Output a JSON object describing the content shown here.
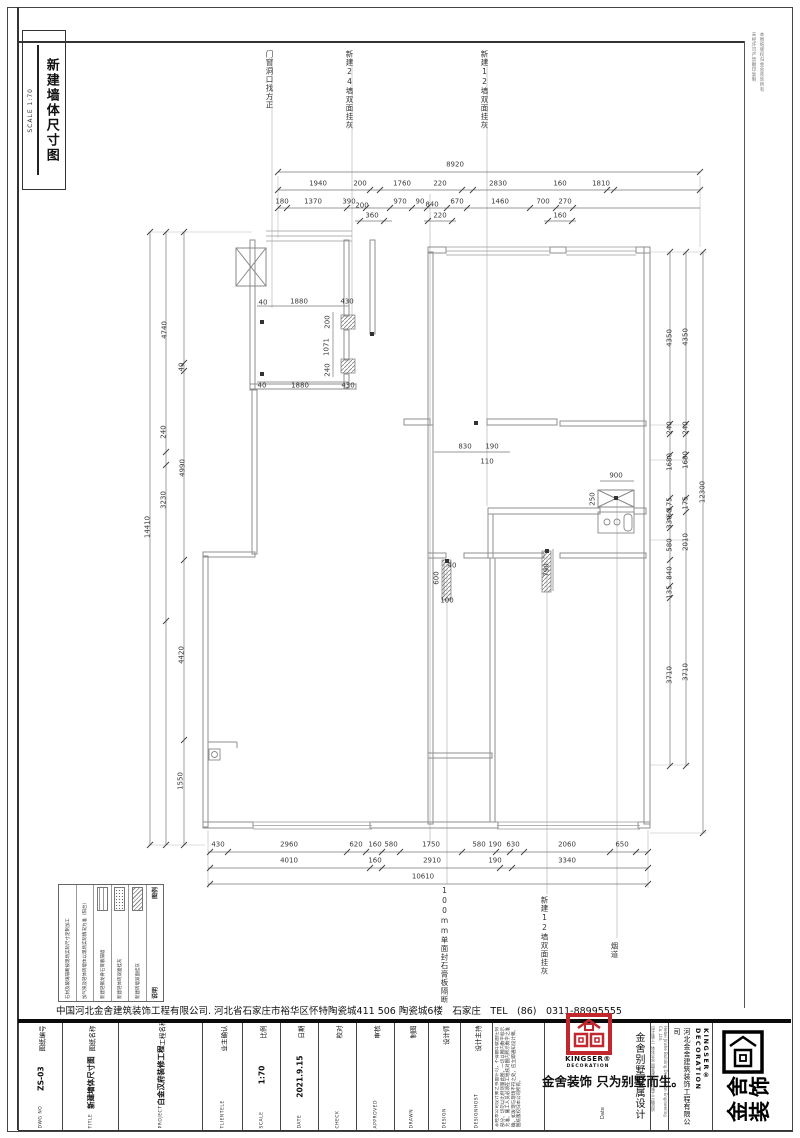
{
  "sheet": {
    "title": "新建墙体尺寸图",
    "scale_label": "SCALE 1:70",
    "margin_note_1": "本图纸版权归金舍装饰所有",
    "margin_note_2": "未经许可严禁翻印复制"
  },
  "company_line": "中国河北金舍建筑装饰工程有限公司. 河北省石家庄市裕华区怀特陶瓷城411 506 陶瓷城6楼　石家庄　TEL　(86)　0311-88995555",
  "annotations": [
    [
      269,
      50,
      "门窗洞口找方正"
    ],
    [
      349,
      50,
      "新建24墙双面挂灰"
    ],
    [
      484,
      50,
      "新建12墙双面挂灰"
    ],
    [
      444,
      886,
      "100mm单面封石膏板隔断"
    ],
    [
      544,
      896,
      "新建12墙双面挂灰"
    ],
    [
      614,
      942,
      "烟道"
    ]
  ],
  "dim_labels": [
    [
      455,
      165,
      "8920",
      0
    ],
    [
      318,
      184,
      "1940",
      0
    ],
    [
      360,
      184,
      "200",
      0
    ],
    [
      402,
      184,
      "1760",
      0
    ],
    [
      440,
      184,
      "220",
      0
    ],
    [
      498,
      184,
      "2830",
      0
    ],
    [
      560,
      184,
      "160",
      0
    ],
    [
      601,
      184,
      "1810",
      0
    ],
    [
      282,
      202,
      "180",
      0
    ],
    [
      313,
      202,
      "1370",
      0
    ],
    [
      349,
      202,
      "390",
      0
    ],
    [
      362,
      206,
      "200",
      0
    ],
    [
      400,
      202,
      "970",
      0
    ],
    [
      420,
      202,
      "90",
      0
    ],
    [
      432,
      205,
      "840",
      0
    ],
    [
      457,
      202,
      "670",
      0
    ],
    [
      500,
      202,
      "1460",
      0
    ],
    [
      543,
      202,
      "700",
      0
    ],
    [
      565,
      202,
      "270",
      0
    ],
    [
      372,
      216,
      "360",
      0
    ],
    [
      440,
      216,
      "220",
      0
    ],
    [
      560,
      216,
      "160",
      0
    ],
    [
      148,
      527,
      "14410",
      1
    ],
    [
      165,
      330,
      "4740",
      1
    ],
    [
      182,
      367,
      "40",
      1
    ],
    [
      164,
      432,
      "240",
      1
    ],
    [
      183,
      468,
      "4990",
      1
    ],
    [
      164,
      500,
      "3230",
      1
    ],
    [
      182,
      655,
      "4420",
      1
    ],
    [
      181,
      781,
      "1550",
      1
    ],
    [
      670,
      338,
      "4350",
      1
    ],
    [
      686,
      337,
      "4350",
      1
    ],
    [
      670,
      428,
      "240",
      1
    ],
    [
      686,
      428,
      "240",
      1
    ],
    [
      670,
      462,
      "1680",
      1
    ],
    [
      686,
      460,
      "1680",
      1
    ],
    [
      670,
      504,
      "175",
      1
    ],
    [
      670,
      513,
      "60",
      1
    ],
    [
      670,
      522,
      "330",
      1
    ],
    [
      686,
      503,
      "175",
      1
    ],
    [
      670,
      545,
      "580",
      1
    ],
    [
      686,
      542,
      "2010",
      1
    ],
    [
      670,
      573,
      "840",
      1
    ],
    [
      670,
      592,
      "135",
      1
    ],
    [
      670,
      675,
      "3710",
      1
    ],
    [
      686,
      672,
      "3710",
      1
    ],
    [
      703,
      492,
      "12300",
      1
    ],
    [
      218,
      845,
      "430",
      0
    ],
    [
      289,
      845,
      "2960",
      0
    ],
    [
      356,
      845,
      "620",
      0
    ],
    [
      375,
      845,
      "160",
      0
    ],
    [
      391,
      845,
      "580",
      0
    ],
    [
      431,
      845,
      "1750",
      0
    ],
    [
      479,
      845,
      "580",
      0
    ],
    [
      495,
      845,
      "190",
      0
    ],
    [
      513,
      845,
      "630",
      0
    ],
    [
      567,
      845,
      "2060",
      0
    ],
    [
      622,
      845,
      "650",
      0
    ],
    [
      289,
      861,
      "4010",
      0
    ],
    [
      375,
      861,
      "160",
      0
    ],
    [
      432,
      861,
      "2910",
      0
    ],
    [
      495,
      861,
      "190",
      0
    ],
    [
      567,
      861,
      "3340",
      0
    ],
    [
      423,
      877,
      "10610",
      0
    ],
    [
      263,
      303,
      "40",
      0
    ],
    [
      299,
      302,
      "1880",
      0
    ],
    [
      347,
      302,
      "430",
      0
    ],
    [
      262,
      386,
      "40",
      0
    ],
    [
      300,
      386,
      "1880",
      0
    ],
    [
      348,
      386,
      "430",
      0
    ],
    [
      328,
      322,
      "200",
      1
    ],
    [
      327,
      347,
      "1071",
      1
    ],
    [
      328,
      370,
      "240",
      1
    ],
    [
      465,
      447,
      "830",
      0
    ],
    [
      492,
      447,
      "190",
      0
    ],
    [
      487,
      462,
      "110",
      0
    ],
    [
      616,
      476,
      "900",
      0
    ],
    [
      593,
      499,
      "250",
      1
    ],
    [
      547,
      570,
      "790",
      1
    ],
    [
      437,
      578,
      "600",
      1
    ],
    [
      452,
      566,
      "40",
      0
    ],
    [
      447,
      601,
      "100",
      0
    ]
  ],
  "legend": {
    "header_symbol": "图例",
    "header_desc": "说明",
    "rows": [
      {
        "swatch": "hatch",
        "label": "新建砖墙双面挂灰"
      },
      {
        "swatch": "stipple",
        "label": "新建轻体砖双面挂灰"
      },
      {
        "swatch": "brick",
        "label": "新建轻钢龙骨石膏板隔墙"
      }
    ],
    "notes": [
      "加气块及轻体砖墙体以现场实际情况为准（阳台）",
      "石材及玻璃隔断按现场实际尺寸定制加工"
    ]
  },
  "title_block": {
    "fields": [
      {
        "cn": "图纸编号",
        "val": "ZS-03",
        "en": "DWG NO"
      },
      {
        "cn": "图纸名称",
        "val": "新建墙体尺寸图",
        "en": "TITLE"
      },
      {
        "cn": "工程名称",
        "val": "白金汉府装修工程",
        "en": "PROJECT"
      },
      {
        "cn": "业主确认",
        "val": "",
        "en": "TLIENTELE"
      },
      {
        "cn": "比例",
        "val": "1:70",
        "en": "SCALE"
      },
      {
        "cn": "日期",
        "val": "2021.9.15",
        "en": "DATE"
      },
      {
        "cn": "校对",
        "val": "",
        "en": "CHECK"
      },
      {
        "cn": "审核",
        "val": "",
        "en": "APPROVED"
      },
      {
        "cn": "制图",
        "val": "",
        "en": "DRAWN"
      },
      {
        "cn": "设计师",
        "val": "",
        "en": "DESIGN"
      },
      {
        "cn": "设计主持",
        "val": "",
        "en": "DESIGNHOST"
      }
    ],
    "disclaimer": "非经本公司设计师之书面许可，不得翻印此图任何部分。切勿以比例测量此图，一切以图内数字标示为准。施工人员必须在工地核对图内所示数字之准确，如发现与现场不符之处，应立即通知设计师。图纸版权归本公司所有。",
    "slogan": "金舍装饰 只为别墅而生。",
    "brand_vertical": "金舍别墅专属设计",
    "date_label": "Date",
    "kingser": "KINGSER®",
    "decoration": "DECORATION",
    "kingser_vertical": "KINGSER® DECORATION",
    "company_vertical": "河北金舍建筑装饰工程有限公司",
    "company_tiny_en": "Hebei Jinshe Building Decoration Engineering Co.,Ltd.",
    "company_tiny_cn": "设计施工一体化企业 国家建筑装饰施工二级资质",
    "logo_big_line1": "金舍",
    "logo_big_line2": "装饰"
  },
  "colors": {
    "accent_red": "#c1272d",
    "line_gray": "#8f8f8f",
    "dim_gray": "#777777"
  }
}
